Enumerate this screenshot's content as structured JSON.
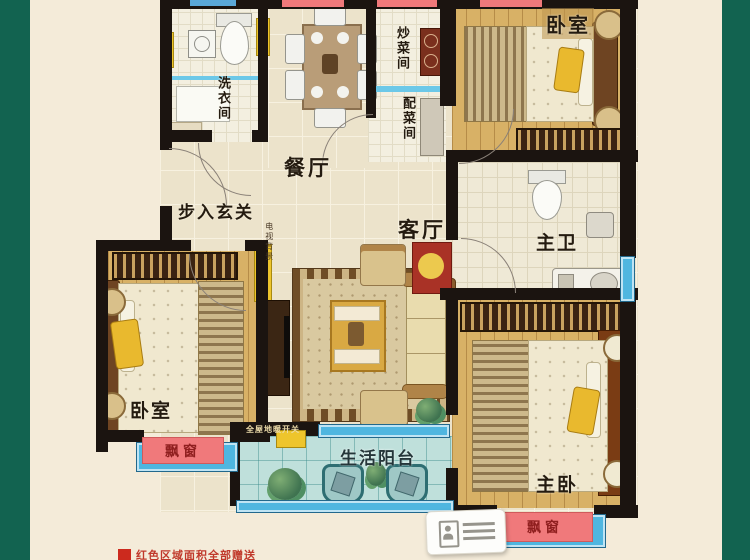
{
  "scene": {
    "type": "apartment-floor-plan"
  },
  "rooms": {
    "dining": {
      "label": "餐厅"
    },
    "cooking": {
      "label": "炒菜间"
    },
    "prep": {
      "label": "配菜间"
    },
    "bedroom_top_right": {
      "label": "卧室"
    },
    "laundry": {
      "label": "洗衣间"
    },
    "entry": {
      "label": "步入玄关"
    },
    "living": {
      "label": "客厅"
    },
    "master_bath": {
      "label": "主卫"
    },
    "bedroom_bottom_left": {
      "label": "卧室"
    },
    "master_bedroom": {
      "label": "主卧"
    },
    "balcony": {
      "label": "生活阳台"
    }
  },
  "annotations": {
    "tv_wall": "电视背景",
    "heating_switch": "全屋地暖开关",
    "bay_left": "飘窗",
    "bay_right": "飘窗"
  },
  "legend": {
    "text": "红色区域面积全部赠送",
    "swatch_color": "#cc2a1e",
    "text_color": "#c0392b"
  },
  "colors": {
    "background_green": "#126350",
    "background_cream": "#f4ebd9",
    "wall": "#1b1410",
    "wood_floor": "#d8b166",
    "tile_floor": "#ece3cb",
    "balcony_teal": "#bfe0db",
    "bay_window_blue": "#4fb6e0",
    "bay_label_red": "#f0797b",
    "accent_yellow": "#eec52c"
  }
}
